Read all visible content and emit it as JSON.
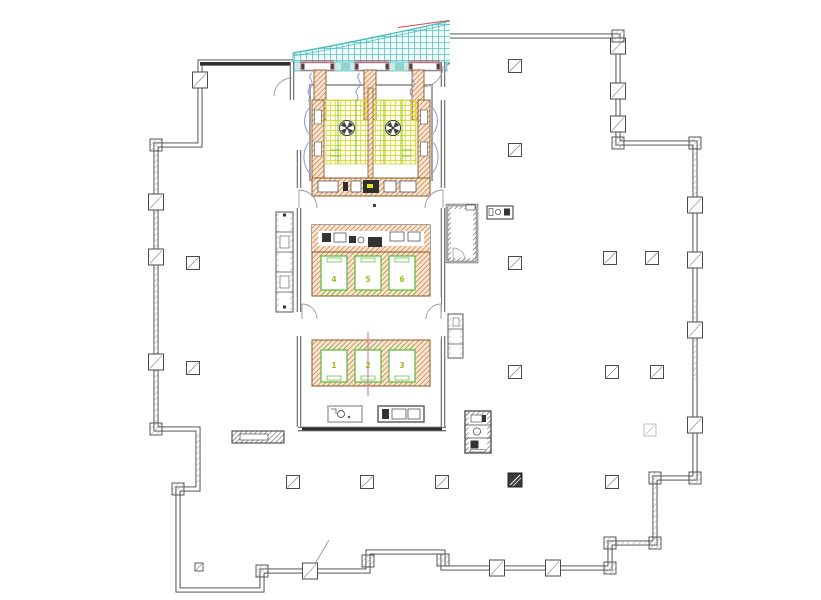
{
  "plan": {
    "type": "office-tower-floor-plan",
    "elevators": [
      {
        "label": "1"
      },
      {
        "label": "2"
      },
      {
        "label": "3"
      },
      {
        "label": "4"
      },
      {
        "label": "5"
      },
      {
        "label": "6"
      }
    ],
    "escalator_count": 2,
    "colors": {
      "wall": "#3f3f3f",
      "core_wall_hatch": "#cf6b2a",
      "escalator_grid_yellow": "#dede2e",
      "escalator_rail_green": "#7ec832",
      "elevator_green": "#58bb36",
      "elevator_label_olive": "#a9b427",
      "canopy_teal": "#49bfbf",
      "entrance_band_fill": "#c9ebe7",
      "air_curtain_blue": "#8a96e0",
      "door_frame_red": "#d84860",
      "centerline_magenta": "#d884a8",
      "door_swing_gray": "#999999",
      "column_dark": "#3b3b3b"
    },
    "symbols": {
      "column_marker": "white square with diagonal slash",
      "dark_column_marker": "dark filled square with white slash",
      "fan_symbol": "circle with four dark wedges",
      "door_swing": "quarter arc",
      "air_curtain": "wavy blue line",
      "canopy": "curved teal hatched glass canopy"
    }
  }
}
